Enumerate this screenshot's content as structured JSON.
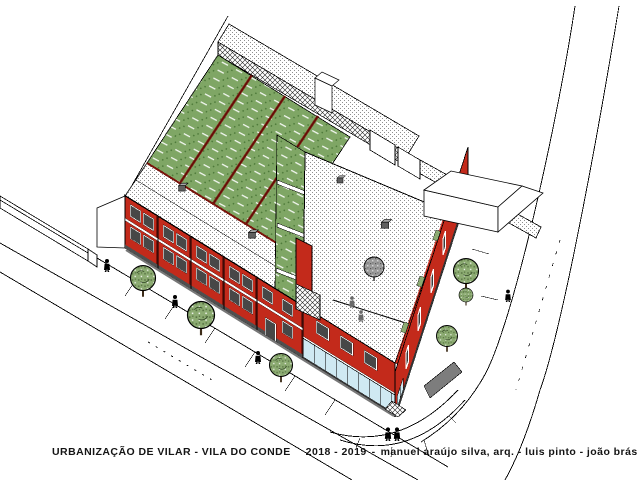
{
  "caption": {
    "title": "URBANIZAÇÃO DE VILAR - VILA DO CONDE",
    "years": "2018 - 2019",
    "separator": "-",
    "credits": "manuel araújo silva, arq. - luis pinto - joão brás arq."
  },
  "colors": {
    "paper": "#ffffff",
    "ink": "#000000",
    "wallRed": "#c32a1b",
    "wallDarkRed": "#7a150c",
    "lawnGreen": "#7fa665",
    "lawnDark": "#4e7a3a",
    "treeGreen": "#8cab72",
    "treeDark": "#55703f",
    "glassBlue": "#cfe9f2",
    "glassDark": "#474747",
    "stippleGray": "#8f8f8f",
    "elementGray": "#7d7d7d"
  },
  "scene": {
    "type": "architectural axonometric site plan",
    "buildings": [
      "terraced-houses-block",
      "central-block",
      "corner-building",
      "rear-garden-annexes",
      "neighbouring-building-outline",
      "small-outline-building"
    ],
    "landscape": [
      "private-lawns",
      "patio-strip",
      "street-trees",
      "terrace-tree",
      "terrace-planters"
    ],
    "streets": [
      "main-street",
      "side-street",
      "corner-sidewalk",
      "boundary-wall",
      "site-boundary-line"
    ],
    "counts": {
      "pedestrians": 6,
      "terrace_figures": 2,
      "street_trees": 6,
      "lawn_plots": 4,
      "chimneys": 4
    }
  }
}
